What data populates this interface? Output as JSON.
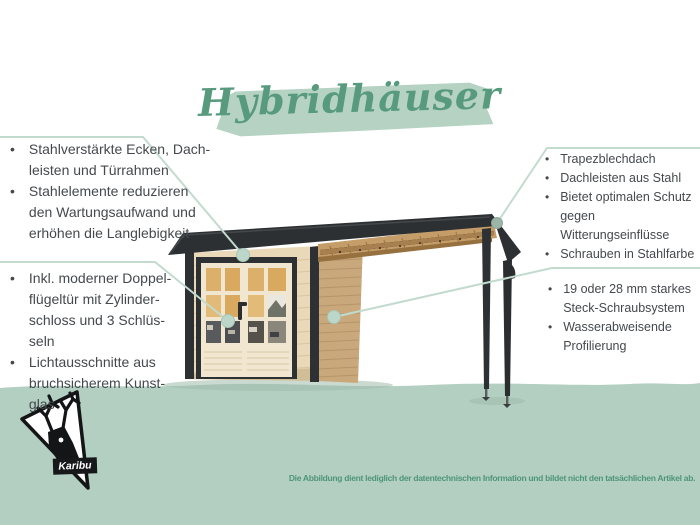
{
  "ui": {
    "bullet": "•"
  },
  "title": {
    "text": "Hybridhäuser"
  },
  "callouts": {
    "left_top": {
      "items": [
        "Stahlverstärkte Ecken, Dach-\nleisten und Türrahmen",
        "Stahlelemente reduzieren\nden Wartungsaufwand und\nerhöhen die Langlebigkeit"
      ]
    },
    "left_bottom": {
      "items": [
        "Inkl. moderner Doppel-\nflügeltür mit Zylinder-\nschloss und 3 Schlüs-\nseln",
        "Lichtausschnitte aus\nbruchsicherem Kunst-\nglas"
      ]
    },
    "right_top": {
      "items": [
        "Trapezblechdach",
        "Dachleisten aus Stahl",
        "Bietet optimalen Schutz\ngegen Witterungseinflüsse",
        "Schrauben in Stahlfarbe"
      ]
    },
    "right_bottom": {
      "items": [
        "19 oder 28 mm starkes\nSteck-Schraubsystem",
        "Wasserabweisende\nProfilierung"
      ]
    }
  },
  "footer": {
    "brand": "Karibu",
    "disclaimer": "Die Abbildung dient lediglich der datentechnischen Information und bildet nicht den tatsächlichen Artikel ab."
  },
  "colors": {
    "accent_green": "#579a7e",
    "brush_green": "#b5d2c2",
    "ground_green": "#b2cfc1",
    "leader_green": "#c2dbce",
    "text_gray": "#45494d",
    "roof_anthracite": "#2d3032",
    "wall_light_wood": "#ead9b8",
    "wall_side_wood": "#c9a87c",
    "pane_amber": "#dcb06b"
  }
}
